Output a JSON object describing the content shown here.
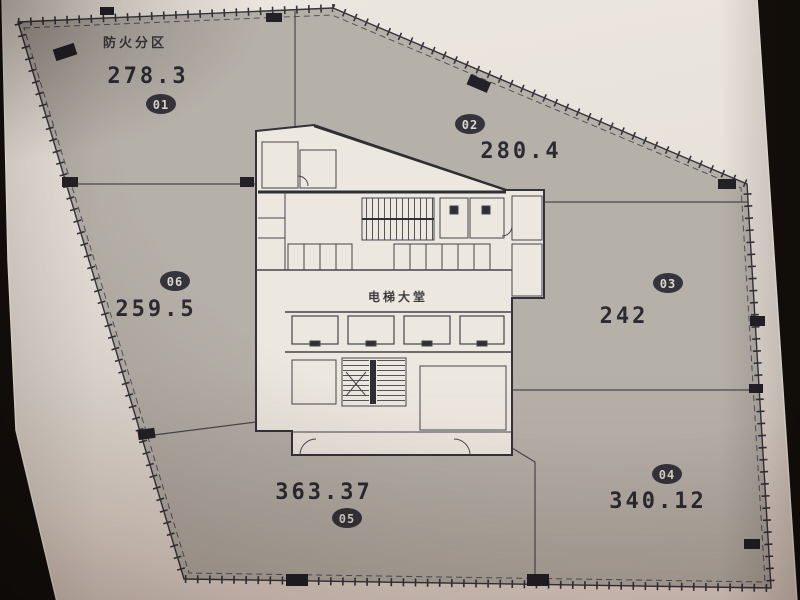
{
  "title": "防火分区",
  "core": {
    "label": "电梯大堂"
  },
  "zones": [
    {
      "id": "01",
      "area": "278.3"
    },
    {
      "id": "02",
      "area": "280.4"
    },
    {
      "id": "03",
      "area": "242"
    },
    {
      "id": "04",
      "area": "340.12"
    },
    {
      "id": "05",
      "area": "363.37"
    },
    {
      "id": "06",
      "area": "259.5"
    }
  ],
  "colors": {
    "background": "#140f0b",
    "paper": "#e9e4dc",
    "zone_fill": "#b5b0a8",
    "core_fill": "#ece8e0",
    "line": "#36343c",
    "zone_line": "#4a4850",
    "text": "#2c2a32",
    "badge_fill": "#35333b",
    "badge_text": "#ddd8cf",
    "column_fill": "#232127"
  }
}
